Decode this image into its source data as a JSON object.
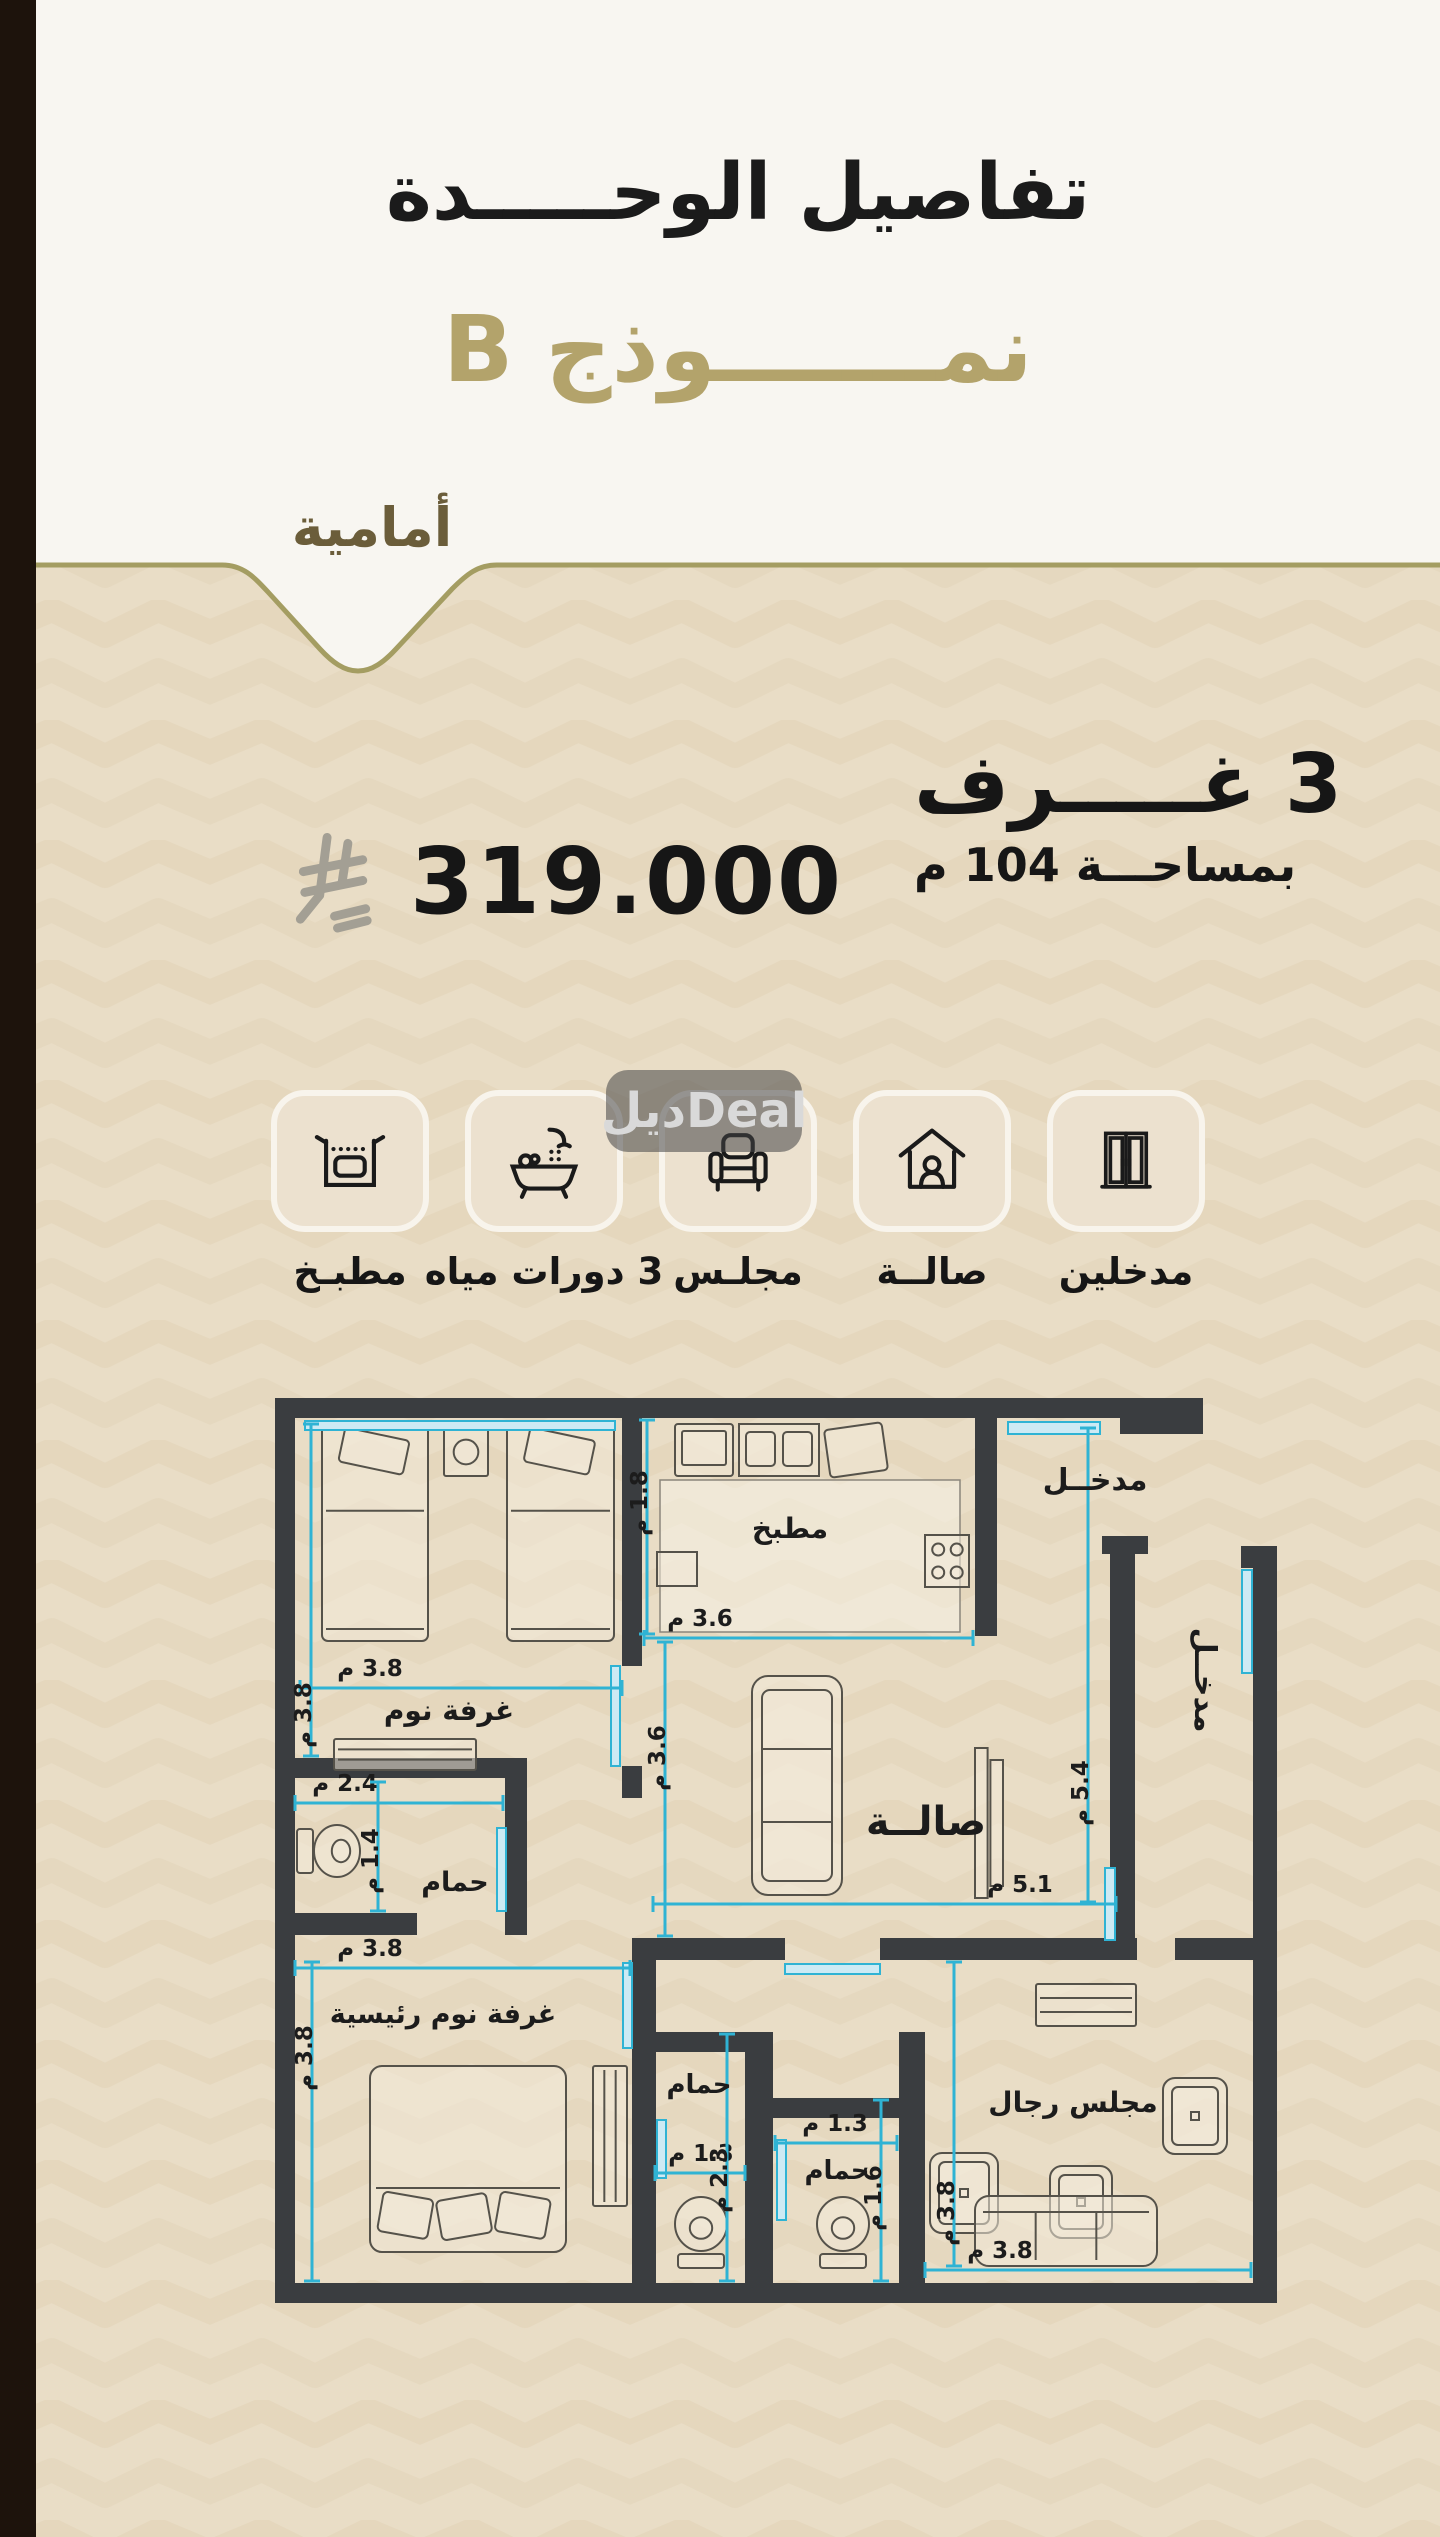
{
  "header": {
    "title": "تفاصيل الوحـــــدة",
    "model": "نمـــــــوذج B",
    "badge": "أمامية"
  },
  "specs": {
    "rooms": "3 غـــــرف",
    "area": "بمساحـــة 104 م",
    "price": "319.000",
    "currency": "ريال سعودي"
  },
  "watermark": "ديلDeal",
  "features": [
    {
      "icon": "kitchen-oven-icon",
      "label": "مطبـخ"
    },
    {
      "icon": "bathtub-shower-icon",
      "label": "3 دورات مياه"
    },
    {
      "icon": "armchair-icon",
      "label": "مجلـس"
    },
    {
      "icon": "house-person-icon",
      "label": "صالــة"
    },
    {
      "icon": "double-door-icon",
      "label": "مدخلين"
    }
  ],
  "colors": {
    "background": "#e9ddc6",
    "pattern": "#dbcbab",
    "header_white": "#f8f6f1",
    "gold_line": "#a49d62",
    "gold_title": "#b3a36b",
    "badge_text": "#6b5d3a",
    "wall": "#3a3d40",
    "dimension": "#2fb3d4",
    "door_fill": "#cdeaf4",
    "furniture": "#55524a",
    "text_dark": "#1c1c1c",
    "sar_symbol": "#a39f94",
    "sidebar": "#1d130c"
  },
  "floor_plan": {
    "unit_suffix": "م",
    "walls": [
      [
        0,
        0,
        928,
        20
      ],
      [
        845,
        20,
        83,
        16
      ],
      [
        0,
        0,
        20,
        905
      ],
      [
        0,
        885,
        1002,
        20
      ],
      [
        978,
        148,
        24,
        757
      ],
      [
        966,
        148,
        36,
        22
      ],
      [
        835,
        138,
        25,
        408
      ],
      [
        827,
        138,
        46,
        18
      ],
      [
        347,
        20,
        20,
        248
      ],
      [
        347,
        368,
        20,
        32
      ],
      [
        700,
        20,
        22,
        218
      ],
      [
        0,
        360,
        252,
        20
      ],
      [
        230,
        380,
        22,
        157
      ],
      [
        0,
        515,
        142,
        22
      ],
      [
        357,
        540,
        153,
        22
      ],
      [
        605,
        540,
        257,
        22
      ],
      [
        900,
        540,
        102,
        22
      ],
      [
        357,
        562,
        24,
        323
      ],
      [
        380,
        634,
        92,
        20
      ],
      [
        470,
        634,
        28,
        251
      ],
      [
        498,
        700,
        128,
        20
      ],
      [
        624,
        634,
        26,
        251
      ]
    ],
    "doors": [
      [
        733,
        24,
        92,
        12
      ],
      [
        967,
        172,
        10,
        103
      ],
      [
        830,
        470,
        10,
        72
      ],
      [
        30,
        23,
        310,
        9
      ],
      [
        336,
        268,
        9,
        100
      ],
      [
        222,
        430,
        9,
        83
      ],
      [
        348,
        565,
        9,
        85
      ],
      [
        510,
        566,
        95,
        10
      ],
      [
        382,
        722,
        9,
        58
      ],
      [
        502,
        742,
        9,
        80
      ]
    ],
    "dims": [
      {
        "x1": 25,
        "y1": 290,
        "x2": 347,
        "y2": 290,
        "t": "3.8 م",
        "lx": 95,
        "ly": 278,
        "rot": 0
      },
      {
        "x1": 36,
        "y1": 26,
        "x2": 36,
        "y2": 358,
        "t": "3.8 م",
        "lx": 36,
        "ly": 317,
        "rot": -90
      },
      {
        "x1": 372,
        "y1": 22,
        "x2": 372,
        "y2": 236,
        "t": "1.8 م",
        "lx": 372,
        "ly": 105,
        "rot": -90
      },
      {
        "x1": 369,
        "y1": 240,
        "x2": 698,
        "y2": 240,
        "t": "3.6 م",
        "lx": 425,
        "ly": 228,
        "rot": 0
      },
      {
        "x1": 390,
        "y1": 244,
        "x2": 390,
        "y2": 538,
        "t": "3.6 م",
        "lx": 390,
        "ly": 360,
        "rot": -90
      },
      {
        "x1": 378,
        "y1": 506,
        "x2": 841,
        "y2": 506,
        "t": "5.1 م",
        "lx": 745,
        "ly": 494,
        "rot": 0
      },
      {
        "x1": 813,
        "y1": 30,
        "x2": 813,
        "y2": 504,
        "t": "5.4 م",
        "lx": 813,
        "ly": 395,
        "rot": -90
      },
      {
        "x1": 20,
        "y1": 405,
        "x2": 228,
        "y2": 405,
        "t": "2.4 م",
        "lx": 70,
        "ly": 393,
        "rot": 0
      },
      {
        "x1": 103,
        "y1": 384,
        "x2": 103,
        "y2": 513,
        "t": "1.4 م",
        "lx": 103,
        "ly": 463,
        "rot": -90
      },
      {
        "x1": 20,
        "y1": 570,
        "x2": 355,
        "y2": 570,
        "t": "3.8 م",
        "lx": 95,
        "ly": 558,
        "rot": 0
      },
      {
        "x1": 37,
        "y1": 564,
        "x2": 37,
        "y2": 883,
        "t": "3.8 م",
        "lx": 37,
        "ly": 660,
        "rot": -90
      },
      {
        "x1": 380,
        "y1": 775,
        "x2": 470,
        "y2": 775,
        "t": "1.3 م",
        "lx": 426,
        "ly": 763,
        "rot": 0
      },
      {
        "x1": 452,
        "y1": 636,
        "x2": 452,
        "y2": 883,
        "t": "2.3 م",
        "lx": 452,
        "ly": 782,
        "rot": -90
      },
      {
        "x1": 500,
        "y1": 745,
        "x2": 622,
        "y2": 745,
        "t": "1.3 م",
        "lx": 560,
        "ly": 733,
        "rot": 0
      },
      {
        "x1": 606,
        "y1": 702,
        "x2": 606,
        "y2": 883,
        "t": "1.6 م",
        "lx": 606,
        "ly": 800,
        "rot": -90
      },
      {
        "x1": 650,
        "y1": 872,
        "x2": 976,
        "y2": 872,
        "t": "3.8 م",
        "lx": 725,
        "ly": 860,
        "rot": 0
      },
      {
        "x1": 679,
        "y1": 564,
        "x2": 679,
        "y2": 868,
        "t": "3.8 م",
        "lx": 679,
        "ly": 815,
        "rot": -90
      }
    ],
    "labels": [
      {
        "x": 174,
        "y": 322,
        "t": "غرفة نوم",
        "s": 28,
        "rot": 0
      },
      {
        "x": 515,
        "y": 140,
        "t": "مطبخ",
        "s": 28,
        "rot": 0
      },
      {
        "x": 820,
        "y": 92,
        "t": "مدخــل",
        "s": 30,
        "rot": 0
      },
      {
        "x": 920,
        "y": 282,
        "t": "مدخــل",
        "s": 30,
        "rot": 90
      },
      {
        "x": 651,
        "y": 437,
        "t": "صالــة",
        "s": 40,
        "rot": 0
      },
      {
        "x": 180,
        "y": 493,
        "t": "حمام",
        "s": 27,
        "rot": 0
      },
      {
        "x": 168,
        "y": 625,
        "t": "غرفة نوم رئيسية",
        "s": 27,
        "rot": 0
      },
      {
        "x": 424,
        "y": 695,
        "t": "حمام",
        "s": 26,
        "rot": 0
      },
      {
        "x": 562,
        "y": 781,
        "t": "حمام",
        "s": 26,
        "rot": 0
      },
      {
        "x": 798,
        "y": 714,
        "t": "مجلس رجال",
        "s": 28,
        "rot": 0
      }
    ],
    "furniture": [
      {
        "t": "kfloor",
        "x": 385,
        "y": 82,
        "w": 300,
        "h": 152
      },
      {
        "t": "bed",
        "x": 47,
        "y": 26,
        "w": 106,
        "h": 217
      },
      {
        "t": "bed",
        "x": 232,
        "y": 26,
        "w": 107,
        "h": 217
      },
      {
        "t": "unit",
        "x": 169,
        "y": 30,
        "w": 44,
        "h": 48
      },
      {
        "t": "stripes",
        "x": 59,
        "y": 341,
        "w": 142,
        "h": 31,
        "o": "h"
      },
      {
        "t": "fridge",
        "x": 400,
        "y": 26,
        "w": 58,
        "h": 52
      },
      {
        "t": "sink2",
        "x": 464,
        "y": 26,
        "w": 80,
        "h": 52
      },
      {
        "t": "board",
        "x": 552,
        "y": 28,
        "w": 58,
        "h": 48
      },
      {
        "t": "stove",
        "x": 650,
        "y": 137,
        "w": 44,
        "h": 52
      },
      {
        "t": "box",
        "x": 382,
        "y": 154,
        "w": 40,
        "h": 34
      },
      {
        "t": "sofa",
        "x": 477,
        "y": 278,
        "w": 90,
        "h": 219
      },
      {
        "t": "tv",
        "x": 700,
        "y": 350,
        "w": 28,
        "h": 150
      },
      {
        "t": "toilet",
        "x": 22,
        "y": 425,
        "w": 66,
        "h": 56,
        "o": "h"
      },
      {
        "t": "dbed",
        "x": 95,
        "y": 668,
        "w": 196,
        "h": 186
      },
      {
        "t": "stripes",
        "x": 318,
        "y": 668,
        "w": 34,
        "h": 140,
        "o": "v"
      },
      {
        "t": "toilet",
        "x": 398,
        "y": 798,
        "w": 56,
        "h": 74,
        "o": "v"
      },
      {
        "t": "toilet",
        "x": 540,
        "y": 798,
        "w": 56,
        "h": 74,
        "o": "v"
      },
      {
        "t": "stripes",
        "x": 761,
        "y": 586,
        "w": 100,
        "h": 42,
        "o": "h"
      },
      {
        "t": "chair",
        "x": 655,
        "y": 755,
        "w": 68,
        "h": 80
      },
      {
        "t": "chair",
        "x": 775,
        "y": 768,
        "w": 62,
        "h": 72
      },
      {
        "t": "chair",
        "x": 888,
        "y": 680,
        "w": 64,
        "h": 76
      },
      {
        "t": "hsofa",
        "x": 700,
        "y": 798,
        "w": 182,
        "h": 70
      }
    ]
  }
}
